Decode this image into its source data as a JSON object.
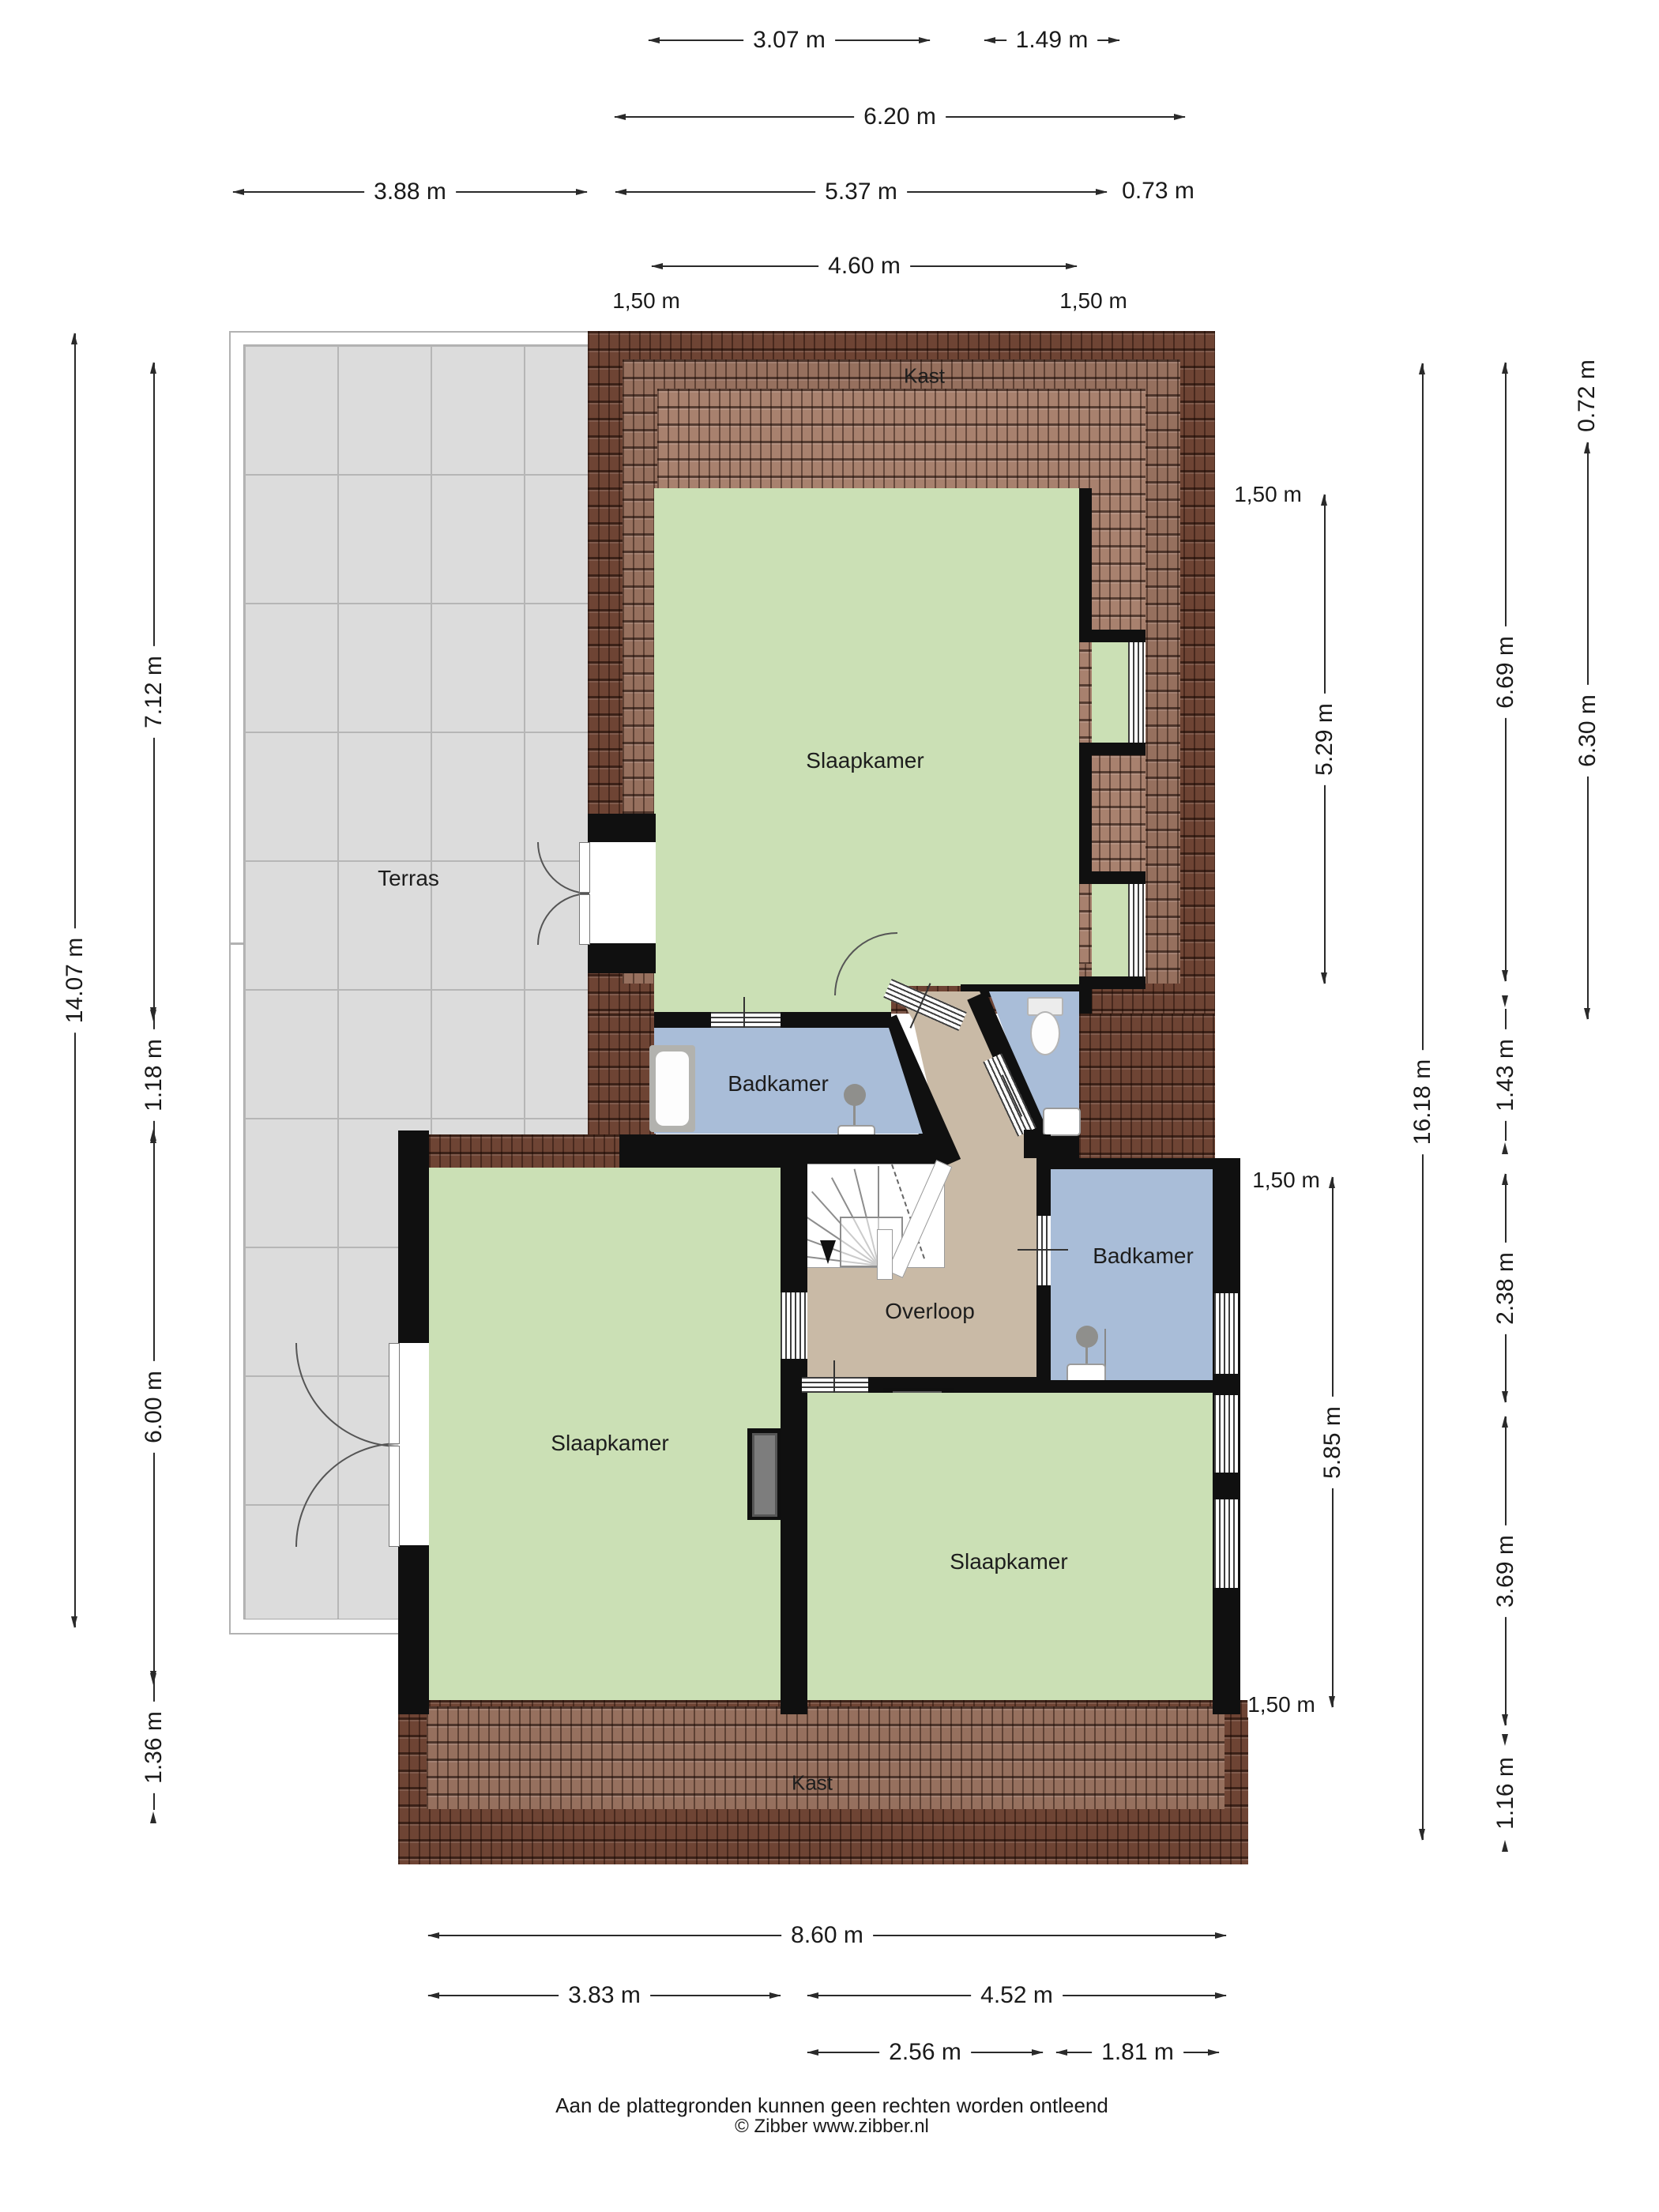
{
  "rooms": {
    "kast_top": "Kast",
    "slaapkamer_top": "Slaapkamer",
    "terras": "Terras",
    "badkamer_left": "Badkamer",
    "overloop": "Overloop",
    "badkamer_right": "Badkamer",
    "slaapkamer_bottom_left": "Slaapkamer",
    "slaapkamer_bottom_right": "Slaapkamer",
    "kast_bottom": "Kast"
  },
  "dims": {
    "top_307": "3.07 m",
    "top_149": "1.49 m",
    "top_620": "6.20 m",
    "top_388": "3.88 m",
    "top_537": "5.37 m",
    "top_073": "0.73 m",
    "top_460": "4.60 m",
    "top_150_left": "1,50 m",
    "top_150_right": "1,50 m",
    "left_1407": "14.07 m",
    "left_712": "7.12 m",
    "left_118": "1.18 m",
    "left_600": "6.00 m",
    "left_136": "1.36 m",
    "right_150_top": "1,50 m",
    "right_529": "5.29 m",
    "right_150_mid": "1,50 m",
    "right_585": "5.85 m",
    "right_150_bottom": "1,50 m",
    "right_1618": "16.18 m",
    "right_669": "6.69 m",
    "right_143": "1.43 m",
    "right_238": "2.38 m",
    "right_369": "3.69 m",
    "right_116": "1.16 m",
    "right_072": "0.72 m",
    "right_630": "6.30 m",
    "bottom_860": "8.60 m",
    "bottom_383": "3.83 m",
    "bottom_452": "4.52 m",
    "bottom_256": "2.56 m",
    "bottom_181": "1.81 m"
  },
  "footer": {
    "line1": "Aan de plattegronden kunnen geen rechten worden ontleend",
    "line2": "© Zibber www.zibber.nl"
  },
  "icons": {
    "shower_left": "shower-icon",
    "shower_right": "shower-icon",
    "bathtub": "bathtub-icon",
    "toilet": "toilet-icon",
    "sink_left": "sink-icon",
    "sink_toilet": "sink-icon",
    "sink_right": "sink-icon",
    "stairs_arrow": "down-arrow-icon"
  },
  "colors": {
    "wall": "#101010",
    "room_green": "#cbe0b5",
    "room_blue": "#a9bdd8",
    "hall_tan": "#c9baa6",
    "roof_dark": "#6e4434",
    "roof_mid": "#96705e",
    "roof_light": "#a8816e",
    "terrace_gray": "#dcdcdc"
  }
}
